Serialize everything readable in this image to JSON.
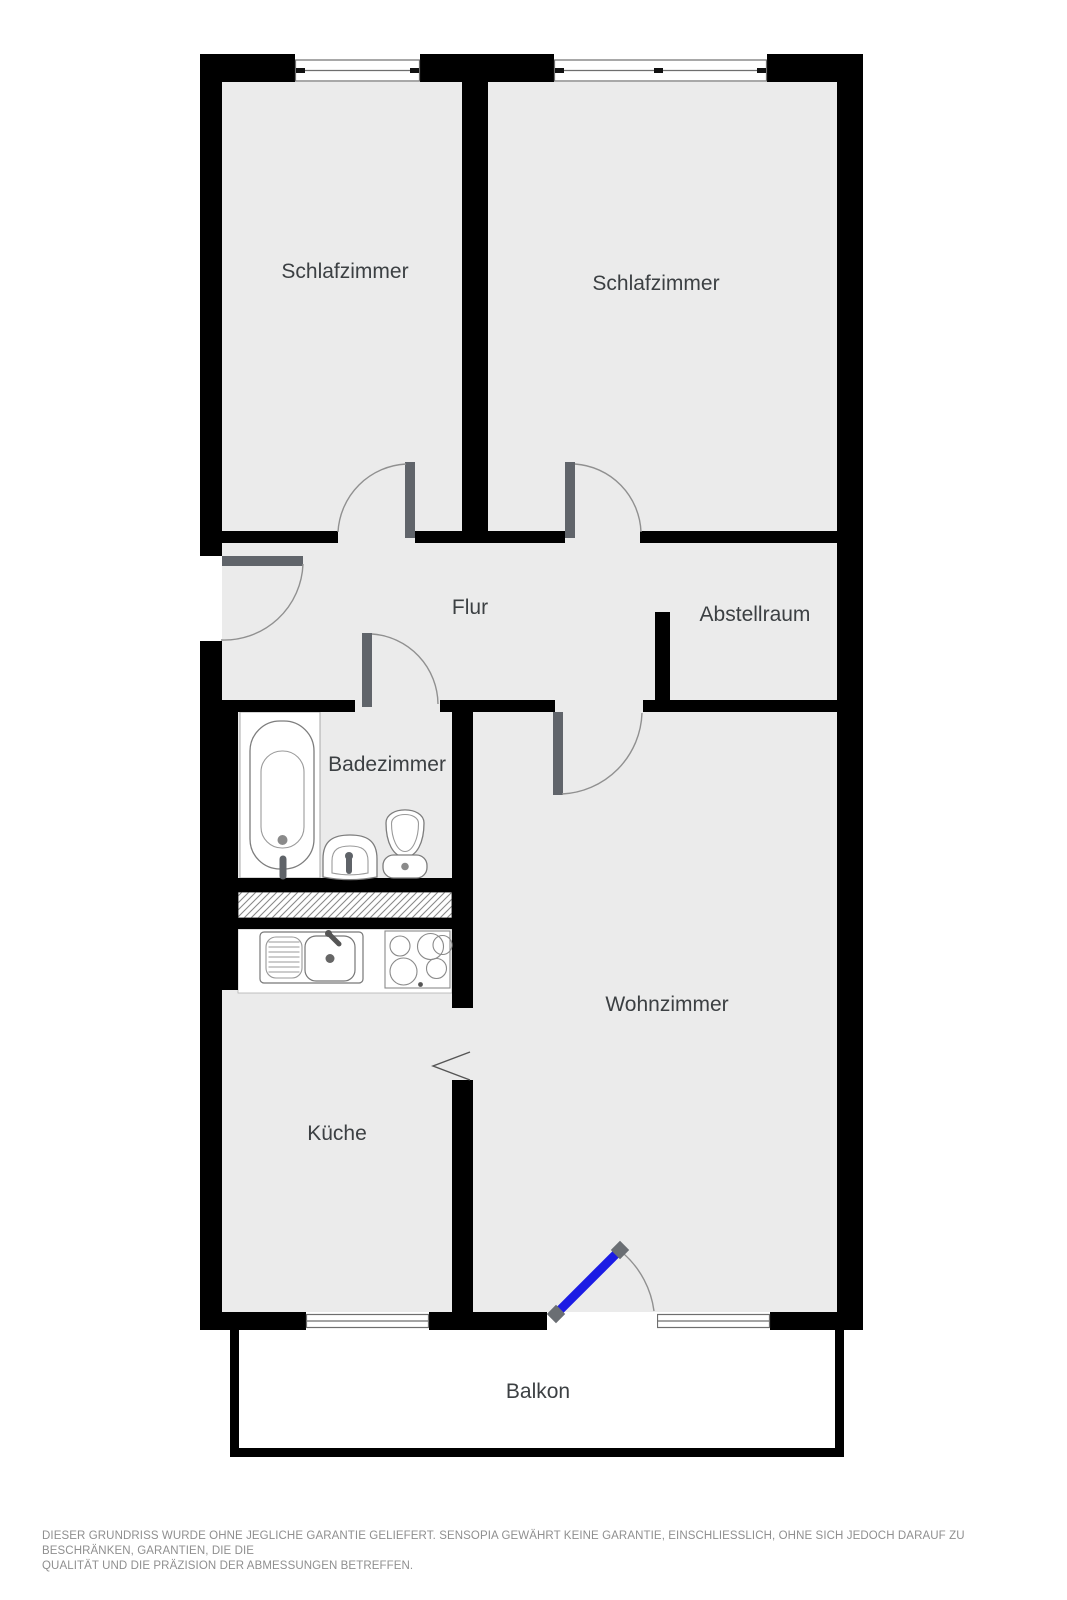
{
  "floor_plan": {
    "rooms": [
      {
        "id": "schlafzimmer-links",
        "label": "Schlafzimmer"
      },
      {
        "id": "schlafzimmer-rechts",
        "label": "Schlafzimmer"
      },
      {
        "id": "flur",
        "label": "Flur"
      },
      {
        "id": "abstellraum",
        "label": "Abstellraum"
      },
      {
        "id": "badezimmer",
        "label": "Badezimmer"
      },
      {
        "id": "wohnzimmer",
        "label": "Wohnzimmer"
      },
      {
        "id": "kueche",
        "label": "Küche"
      },
      {
        "id": "balkon",
        "label": "Balkon"
      }
    ],
    "fixtures": [
      {
        "name": "bathtub"
      },
      {
        "name": "washbasin"
      },
      {
        "name": "toilet"
      },
      {
        "name": "kitchen-sink"
      },
      {
        "name": "stove-cooktop"
      },
      {
        "name": "ventilation-shaft"
      }
    ],
    "doors": [
      {
        "name": "entrance-door"
      },
      {
        "name": "bedroom-left-door"
      },
      {
        "name": "bedroom-right-door"
      },
      {
        "name": "bathroom-door"
      },
      {
        "name": "living-room-door"
      },
      {
        "name": "balcony-door"
      },
      {
        "name": "kitchen-passage-opening"
      },
      {
        "name": "storage-room-opening"
      }
    ],
    "windows": [
      {
        "name": "bedroom-left-window"
      },
      {
        "name": "bedroom-right-window"
      },
      {
        "name": "kitchen-window"
      },
      {
        "name": "balcony-window"
      }
    ],
    "colors": {
      "wall": "#000000",
      "floor": "#ebebeb",
      "balcony_floor": "#ffffff",
      "door_leaf": "#60646a",
      "swing_arc": "#909090",
      "balcony_door_blue": "#1b1be4",
      "window_frame": "#6e6e6e",
      "room_label": "#3c4043",
      "disclaimer_text": "#8f8f8f"
    }
  },
  "footer": {
    "disclaimer_line1": "DIESER GRUNDRISS WURDE OHNE JEGLICHE GARANTIE GELIEFERT. SENSOPIA GEWÄHRT KEINE GARANTIE, EINSCHLIESSLICH, OHNE SICH JEDOCH DARAUF ZU BESCHRÄNKEN, GARANTIEN, DIE DIE",
    "disclaimer_line2": "QUALITÄT UND DIE PRÄZISION DER ABMESSUNGEN BETREFFEN."
  }
}
